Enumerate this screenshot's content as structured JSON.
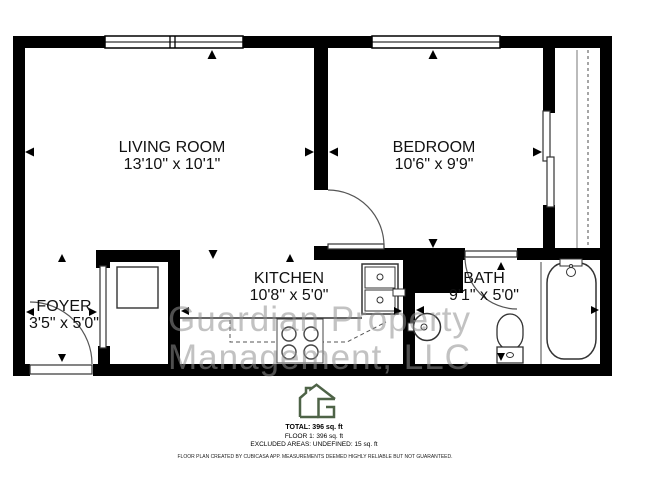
{
  "rooms": {
    "living": {
      "label": "LIVING ROOM",
      "dims": "13'10\" x 10'1\""
    },
    "bedroom": {
      "label": "BEDROOM",
      "dims": "10'6\" x 9'9\""
    },
    "kitchen": {
      "label": "KITCHEN",
      "dims": "10'8\" x 5'0\""
    },
    "bath": {
      "label": "BATH",
      "dims": "9'1\" x 5'0\""
    },
    "foyer": {
      "label": "FOYER",
      "dims": "3'5\" x 5'0\""
    }
  },
  "watermark": {
    "line1": "Guardian Property",
    "line2": "Management, LLC",
    "color": "#8f8f8f"
  },
  "footer": {
    "logo": "cubicasa-house-g-logo",
    "logo_color": "#4e6347",
    "total": "TOTAL: 396 sq. ft",
    "floor": "FLOOR 1: 396 sq. ft",
    "excluded": "EXCLUDED AREAS: UNDEFINED: 15 sq. ft",
    "disclaimer": "FLOOR PLAN CREATED BY CUBICASA APP. MEASUREMENTS DEEMED HIGHLY RELIABLE BUT NOT GUARANTEED."
  }
}
